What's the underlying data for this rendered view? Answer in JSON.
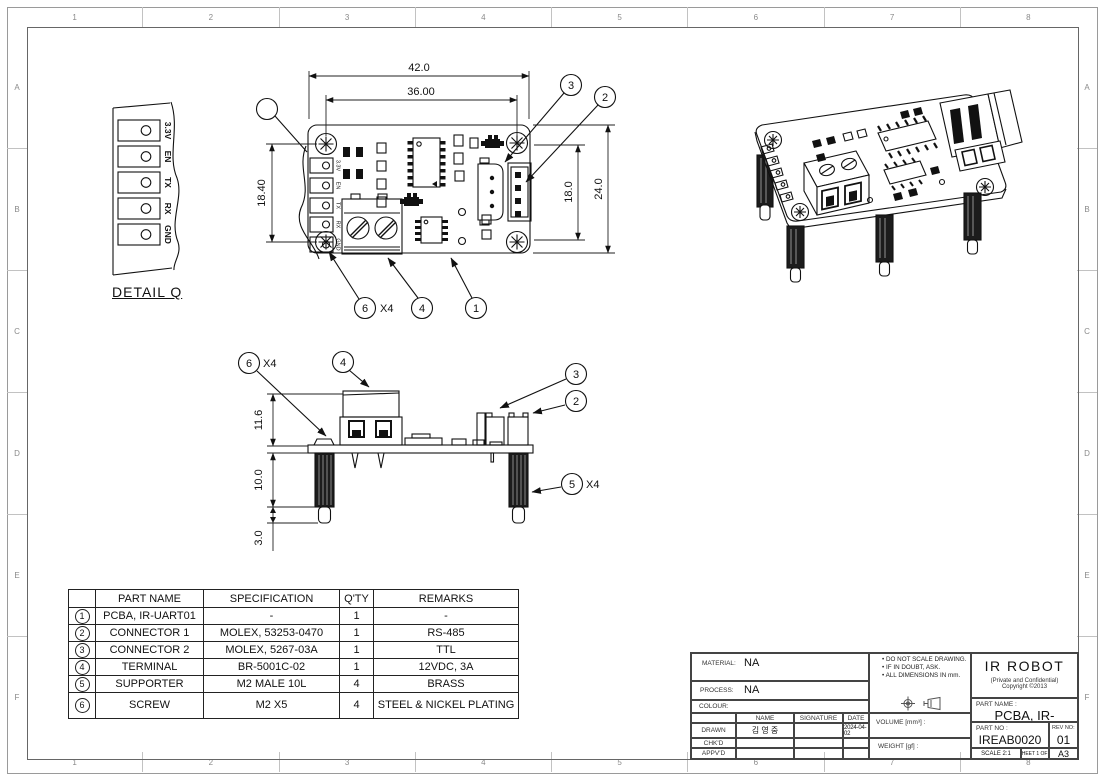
{
  "sheet": {
    "columns": [
      "1",
      "2",
      "3",
      "4",
      "5",
      "6",
      "7",
      "8"
    ],
    "rows": [
      "A",
      "B",
      "C",
      "D",
      "E",
      "F"
    ]
  },
  "pin_labels": [
    "3.3V",
    "EN",
    "TX",
    "RX",
    "GND"
  ],
  "detail_q": {
    "title": "DETAIL Q"
  },
  "top_view": {
    "dim_42": "42.0",
    "dim_36": "36.00",
    "dim_18_40": "18.40",
    "dim_18": "18.0",
    "dim_24": "24.0",
    "balloon_1": "1",
    "balloon_2": "2",
    "balloon_3": "3",
    "balloon_4": "4",
    "balloon_6": "6",
    "qty_x4": "X4"
  },
  "side_view": {
    "dim_11_6": "11.6",
    "dim_10": "10.0",
    "dim_3": "3.0",
    "balloon_2": "2",
    "balloon_3": "3",
    "balloon_4": "4",
    "balloon_5": "5",
    "balloon_6": "6",
    "qty_x4_screw": "X4",
    "qty_x4_supporter": "X4"
  },
  "bom": {
    "headers": {
      "no": "",
      "part_name": "PART NAME",
      "spec": "SPECIFICATION",
      "qty": "Q'TY",
      "remarks": "REMARKS"
    },
    "rows": [
      {
        "no": "1",
        "part_name": "PCBA, IR-UART01",
        "spec": "-",
        "qty": "1",
        "remarks": "-"
      },
      {
        "no": "2",
        "part_name": "CONNECTOR 1",
        "spec": "MOLEX, 53253-0470",
        "qty": "1",
        "remarks": "RS-485"
      },
      {
        "no": "3",
        "part_name": "CONNECTOR 2",
        "spec": "MOLEX, 5267-03A",
        "qty": "1",
        "remarks": "TTL"
      },
      {
        "no": "4",
        "part_name": "TERMINAL",
        "spec": "BR-5001C-02",
        "qty": "1",
        "remarks": "12VDC, 3A"
      },
      {
        "no": "5",
        "part_name": "SUPPORTER",
        "spec": "M2 MALE 10L",
        "qty": "4",
        "remarks": "BRASS"
      },
      {
        "no": "6",
        "part_name": "SCREW",
        "spec": "M2 X5",
        "qty": "4",
        "remarks": "STEEL & NICKEL PLATING"
      }
    ]
  },
  "title_block": {
    "material_label": "MATERIAL:",
    "material_value": "NA",
    "process_label": "PROCESS:",
    "process_value": "NA",
    "colour_label": "COLOUR:",
    "sign_table": {
      "name": "NAME",
      "signature": "SIGNATURE",
      "date": "DATE",
      "drawn_label": "DRAWN",
      "drawn_name": "김 영 중",
      "drawn_date": "2024-04-02",
      "chkd_label": "CHK'D",
      "appvd_label": "APPV'D"
    },
    "notes": [
      "DO NOT SCALE DRAWING.",
      "IF IN DOUBT, ASK.",
      "ALL DIMENSIONS IN mm."
    ],
    "volume_label": "VOLUME [mm³] :",
    "weight_label": "WEIGHT [gf] :",
    "company": "IR ROBOT",
    "confidential": "(Private and Confidential)",
    "copyright": "Copyright ©2013",
    "part_name_label": "PART NAME :",
    "part_name": "PCBA, IR-UART01",
    "part_no_label": "PART NO :",
    "part_no": "IREAB0020",
    "rev_no_label": "REV NO:",
    "rev_no": "01",
    "scale": "SCALE 2:1",
    "sheet": "SHEET 1 OF 1",
    "size": "A3"
  }
}
